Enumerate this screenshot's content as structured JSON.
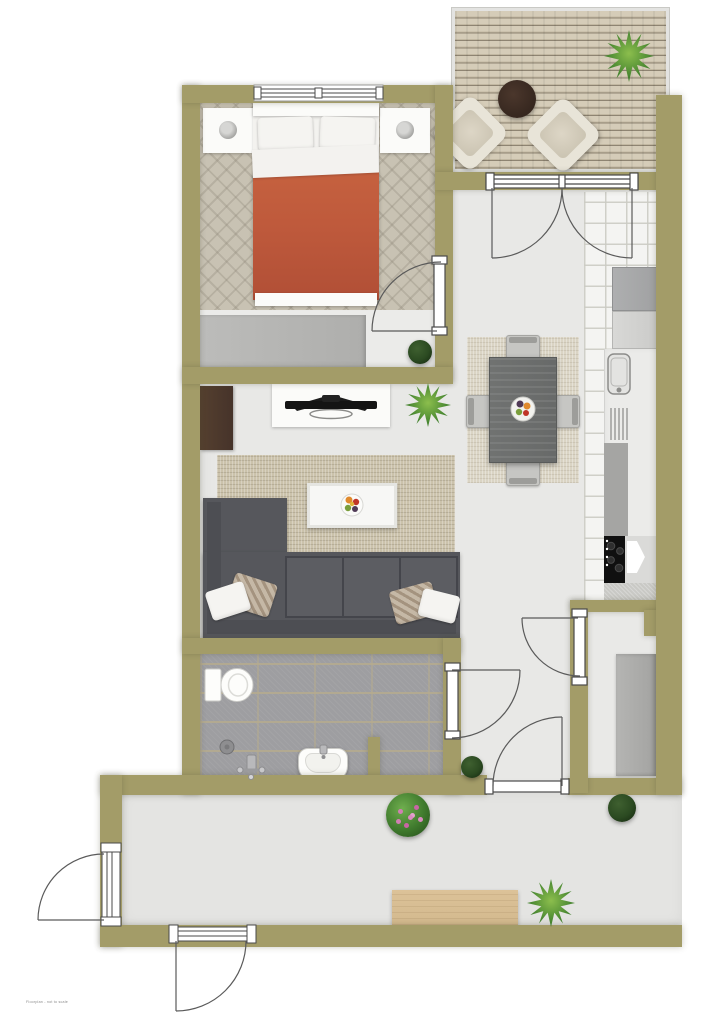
{
  "document": {
    "type": "apartment-floor-plan-rendering",
    "watermark_text": "Floorplan - not to scale"
  },
  "palette": {
    "wall": "#a39c68",
    "floor": "#e8e8e6",
    "hall_floor": "#e4e4e2",
    "carpet": "#c8c2b3",
    "bath_tile": "#9e9ea1",
    "kitchen_tile": "#f4f4f2",
    "rug_living": "#cbc2ab",
    "rug_dining": "#dad4c4",
    "sofa": "#56575c",
    "duvet": "#bf5a3c",
    "cabinet_brown": "#46332a",
    "table_round": "#36271f",
    "dining_table": "#6b6d6c",
    "sideboard": "#d3b98e",
    "appliance": "#a0a1a2",
    "stove": "#111111",
    "plant_green": "#4c8a33",
    "plant_dark": "#2b4a21",
    "flower_pink": "#d27fb4"
  },
  "rooms": {
    "bedroom": {
      "name": "bedroom",
      "furniture": [
        "double-bed",
        "pillow",
        "pillow",
        "orange-duvet",
        "nightstand-with-lamp",
        "nightstand-with-lamp",
        "wardrobe",
        "potted-plant",
        "window"
      ]
    },
    "balcony": {
      "name": "balcony",
      "furniture": [
        "wood-decking",
        "lounge-chair",
        "lounge-chair",
        "round-table",
        "potted-plant"
      ]
    },
    "living_room": {
      "name": "living-room",
      "furniture": [
        "corner-sofa",
        "throw-pillows",
        "area-rug",
        "coffee-table",
        "fruit-bowl",
        "tv",
        "tv-console",
        "brown-cabinet",
        "potted-plant"
      ]
    },
    "dining_area": {
      "name": "dining-area",
      "furniture": [
        "dining-table",
        "dining-chair",
        "dining-chair",
        "dining-chair",
        "dining-chair",
        "fruit-bowl",
        "area-rug"
      ]
    },
    "kitchen": {
      "name": "kitchen",
      "furniture": [
        "fridge",
        "cabinet",
        "counter",
        "sink",
        "dish-drainer",
        "cooktop",
        "tile-floor"
      ]
    },
    "bathroom": {
      "name": "bathroom",
      "furniture": [
        "toilet",
        "shower-drain",
        "shower-faucet",
        "washbasin",
        "partition-wall"
      ]
    },
    "storage_room": {
      "name": "storage-room",
      "furniture": [
        "wardrobe"
      ]
    },
    "hallway": {
      "name": "hallway",
      "furniture": [
        "sideboard",
        "flowering-plant",
        "potted-plant",
        "potted-plant"
      ]
    }
  },
  "openings": {
    "windows": [
      "bedroom-window"
    ],
    "doors": [
      "balcony-double-door",
      "bedroom-door",
      "bathroom-door",
      "storage-door",
      "hall-door",
      "garden-door",
      "entrance-door"
    ]
  }
}
